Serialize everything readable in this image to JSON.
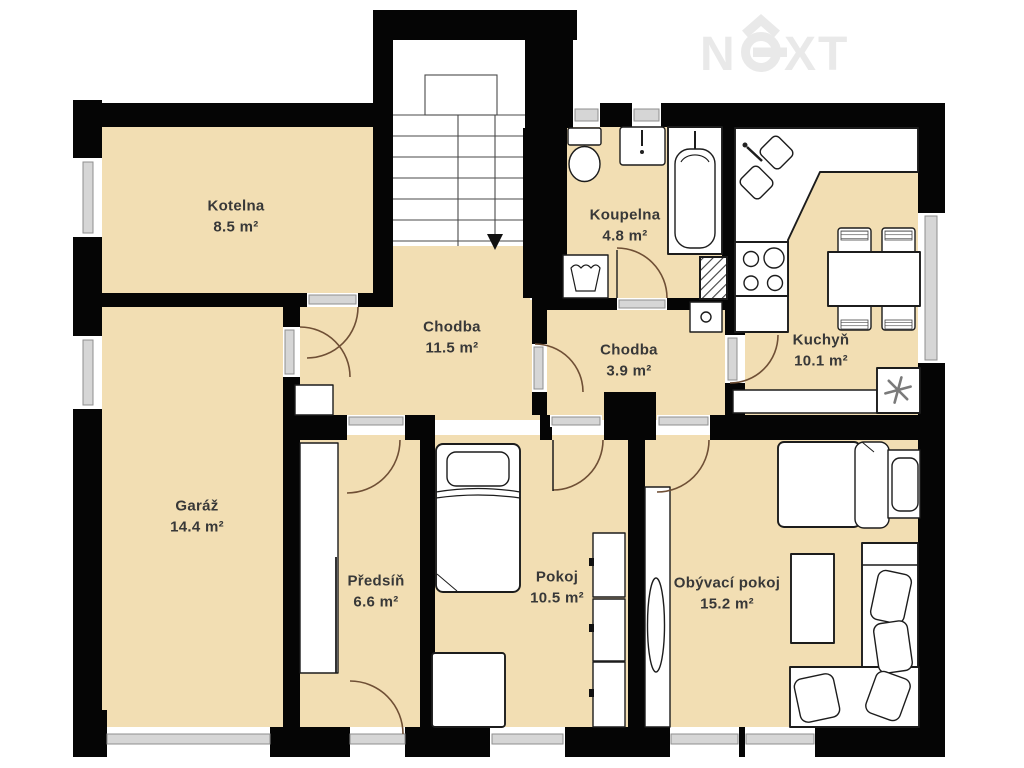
{
  "watermark": {
    "n": "N",
    "xt": "XT",
    "brand": "NEXT"
  },
  "rooms": [
    {
      "id": "kotelna",
      "name": "Kotelna",
      "area": "8.5 m²"
    },
    {
      "id": "koupelna",
      "name": "Koupelna",
      "area": "4.8 m²"
    },
    {
      "id": "kuchyn",
      "name": "Kuchyň",
      "area": "10.1 m²"
    },
    {
      "id": "chodba-horni",
      "name": "Chodba",
      "area": "11.5 m²"
    },
    {
      "id": "chodba-dolni",
      "name": "Chodba",
      "area": "3.9 m²"
    },
    {
      "id": "garaz",
      "name": "Garáž",
      "area": "14.4 m²"
    },
    {
      "id": "predsin",
      "name": "Předsíň",
      "area": "6.6 m²"
    },
    {
      "id": "pokoj",
      "name": "Pokoj",
      "area": "10.5 m²"
    },
    {
      "id": "obyvaci-pokoj",
      "name": "Obývací pokoj",
      "area": "15.2 m²"
    }
  ],
  "colors": {
    "wall": "#050505",
    "floor": "#f2deb3",
    "furniture_outline": "#1c1c1c",
    "door_arc": "#6f4f35",
    "window_fill": "#d6d6d6",
    "window_stroke": "#8f8f8f",
    "watermark": "#e9e9e9",
    "label_text": "#383838",
    "background": "#ffffff"
  }
}
